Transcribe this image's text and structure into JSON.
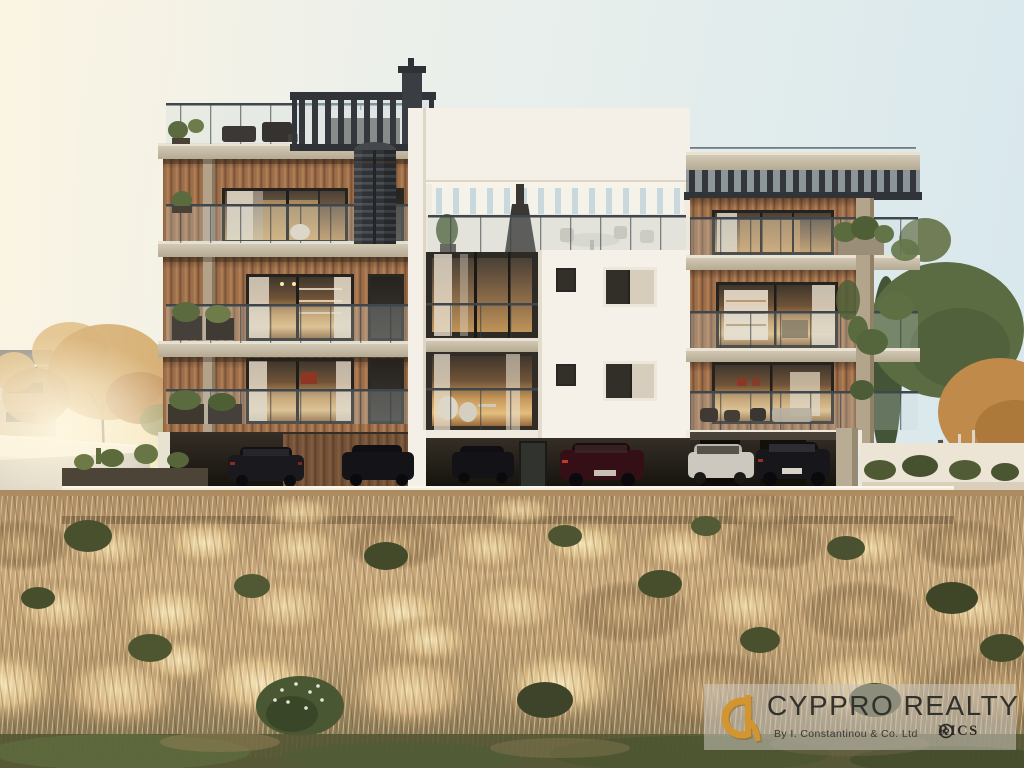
{
  "watermark": {
    "brand": "CYPPRO REALTY",
    "byline": "By I. Constantinou & Co. Ltd",
    "rics_label": "RICS",
    "logo_icon": "cyppro-monogram-icon",
    "rics_icon": "rics-emblem-icon"
  },
  "colors": {
    "sky_top": "#d6e7ed",
    "sky_mid": "#e9efec",
    "sky_horizon": "#f7f2e4",
    "sun_glow": "#fff6dd",
    "building_white": "#f4f0e7",
    "building_shade": "#ddd6c6",
    "wood": "#9c6e49",
    "wood_dark": "#7b543a",
    "wood_light": "#b07e55",
    "concrete_top": "#d8cfbc",
    "concrete_face": "#b5aa93",
    "pergola_dark": "#34373b",
    "glass_dark": "#2e2a26",
    "window_glow": "#d8a868",
    "curtain": "#e9dfcd",
    "rail_dark": "#3f464c",
    "balustrade_tint": "rgba(200,215,220,0.25)",
    "parking_dark": "#16120d",
    "car_red": "#341016",
    "car_white": "#ccc7bf",
    "wall_white": "#f2ecdf",
    "road": "#b7b3ab",
    "plant_green": "#5a6b3e",
    "tree_autumn": "#c99952",
    "tree_green": "#5b6c43",
    "grass_light": "#e8d0a0",
    "grass_gold": "#c7a678",
    "grass_shadow": "#8c7850",
    "bush_green": "#49502e",
    "ground_green": "#545634",
    "panel_bg": "rgba(203,199,190,0.55)",
    "wm_text": "#32312c",
    "wm_sub": "#3a3933",
    "brand_gold": "#d2952f",
    "rics_dark": "#2c2b26"
  }
}
